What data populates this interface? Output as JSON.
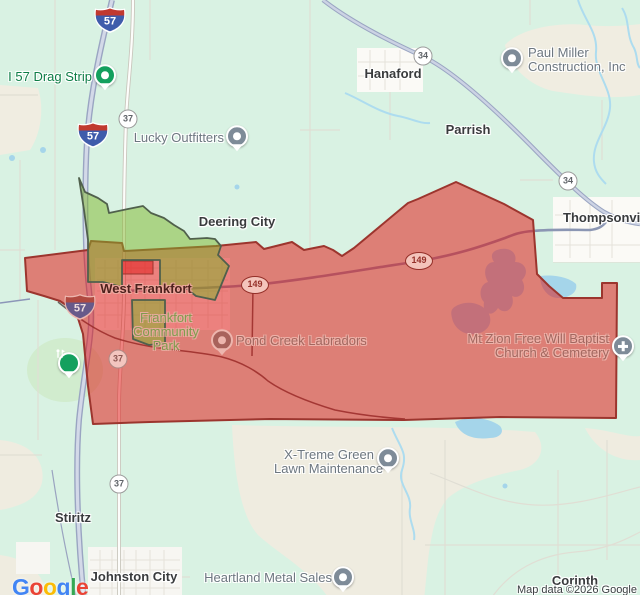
{
  "map": {
    "attribution": "Map data ©2026 Google",
    "google_logo": {
      "letters": [
        "G",
        "o",
        "o",
        "g",
        "l",
        "e"
      ],
      "colors": [
        "#4285F4",
        "#EA4335",
        "#FBBC05",
        "#4285F4",
        "#34A853",
        "#EA4335"
      ]
    },
    "towns": [
      {
        "name": "Hanaford"
      },
      {
        "name": "Parrish"
      },
      {
        "name": "Deering City"
      },
      {
        "name": "West Frankfort"
      },
      {
        "name": "Thompsonville"
      },
      {
        "name": "Stiritz"
      },
      {
        "name": "Johnston City"
      },
      {
        "name": "Corinth"
      }
    ],
    "pois": [
      {
        "label": "I 57 Drag Strip"
      },
      {
        "label": "Lucky Outfitters"
      },
      {
        "line1": "Paul Miller",
        "line2": "Construction, Inc"
      },
      {
        "label": "Pond Creek Labradors"
      },
      {
        "line1": "Mt Zion Free Will Baptist",
        "line2": "Church & Cemetery"
      },
      {
        "line1": "Frankfort",
        "line2": "Community",
        "line3": "Park"
      },
      {
        "line1": "X-Treme Green",
        "line2": "Lawn Maintenance"
      },
      {
        "label": "Heartland Metal Sales"
      }
    ],
    "shields": {
      "interstate": "57",
      "route37": "37",
      "route34": "34",
      "route149": "149"
    },
    "overlay": {
      "red_zone_color": "#dd7f77",
      "green_zone_color": "#abd487"
    }
  }
}
